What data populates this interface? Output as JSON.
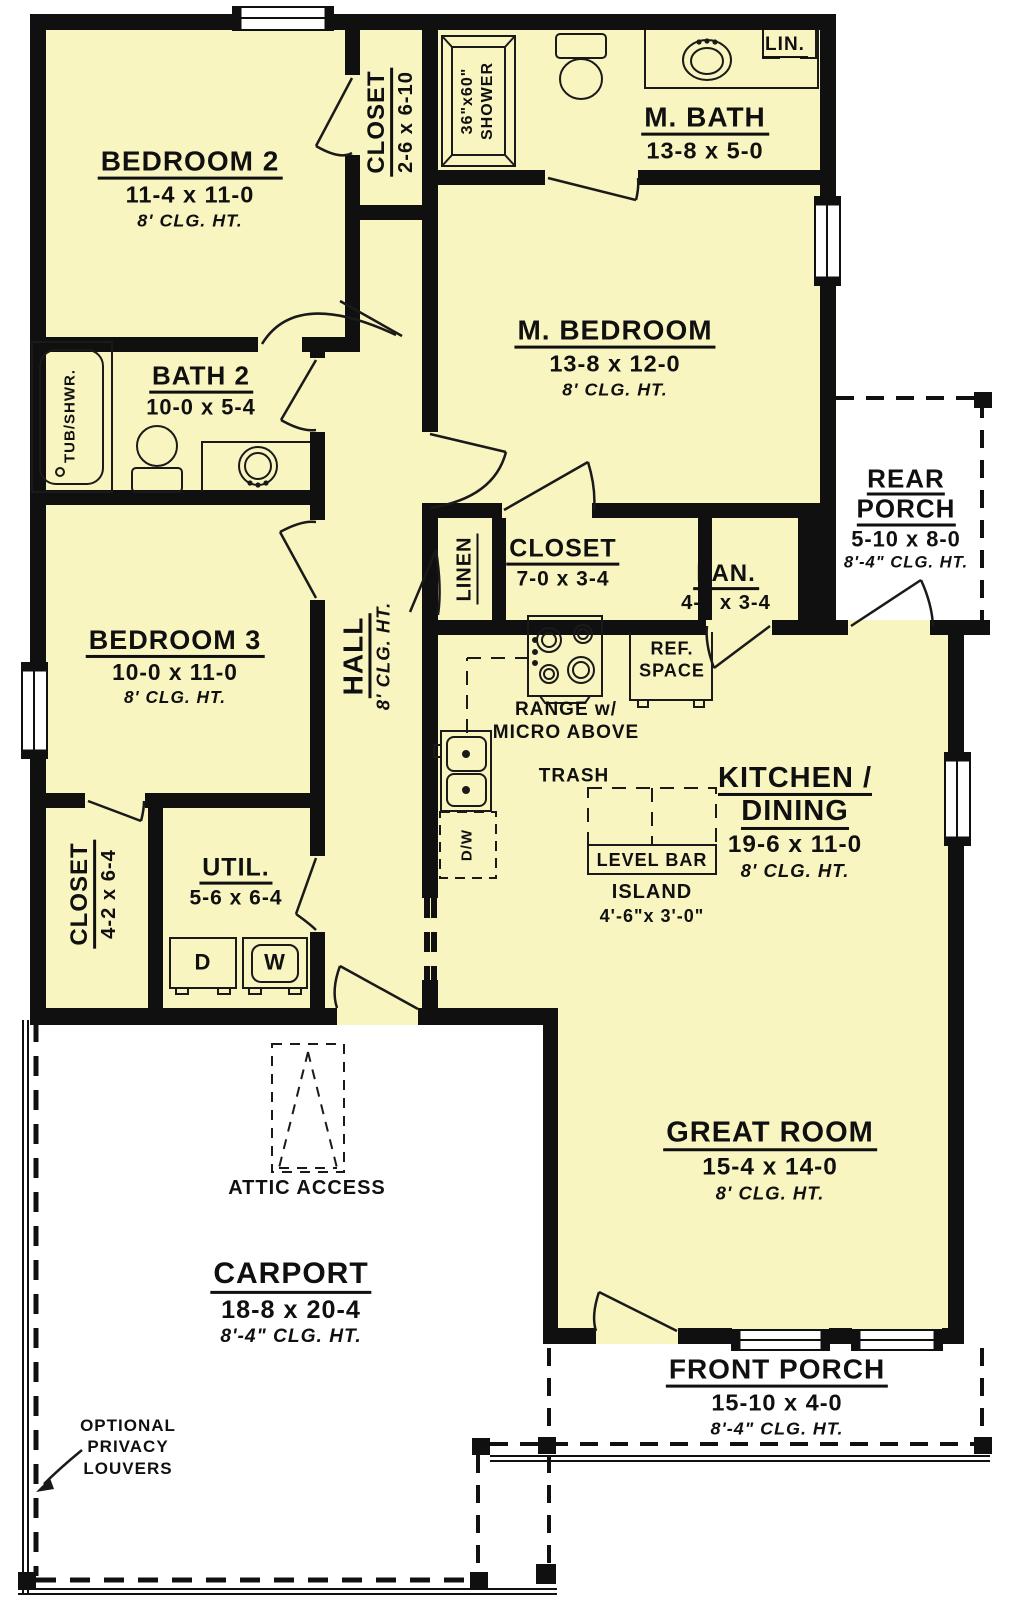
{
  "colors": {
    "room_fill": "#F8F5C1",
    "wall": "#101010",
    "bg": "#FFFFFF",
    "line": "#1A1A1A"
  },
  "rooms": {
    "bedroom2": {
      "name": "BEDROOM 2",
      "dims": "11-4 x 11-0",
      "clg": "8' CLG. HT."
    },
    "closet_bedroom2m": {
      "name": "CLOSET",
      "dims": "2-6 x 6-10"
    },
    "master_bath": {
      "name": "M. BATH",
      "dims": "13-8 x 5-0"
    },
    "lin": {
      "name": "LIN."
    },
    "shower": {
      "size": "36\"x60\"",
      "label": "SHOWER"
    },
    "master_bedroom": {
      "name": "M. BEDROOM",
      "dims": "13-8 x 12-0",
      "clg": "8' CLG. HT."
    },
    "bath2": {
      "name": "BATH 2",
      "dims": "10-0 x 5-4"
    },
    "tub": {
      "label": "TUB/SHWR."
    },
    "bedroom3": {
      "name": "BEDROOM 3",
      "dims": "10-0 x 11-0",
      "clg": "8' CLG. HT."
    },
    "hall": {
      "name": "HALL",
      "clg": "8' CLG. HT."
    },
    "linen": {
      "name": "LINEN"
    },
    "closet_hall": {
      "name": "CLOSET",
      "dims": "7-0 x 3-4"
    },
    "pantry": {
      "name": "PAN.",
      "dims": "4-6 x 3-4"
    },
    "rear_porch": {
      "line1": "REAR",
      "line2": "PORCH",
      "dims": "5-10 x 8-0",
      "clg": "8'-4\" CLG. HT."
    },
    "kitchen": {
      "line1": "KITCHEN /",
      "line2": "DINING",
      "dims": "19-6 x 11-0",
      "clg": "8' CLG. HT."
    },
    "closet_util": {
      "name": "CLOSET",
      "dims": "4-2 x 6-4"
    },
    "util": {
      "name": "UTIL.",
      "dims": "5-6 x 6-4"
    },
    "great_room": {
      "name": "GREAT ROOM",
      "dims": "15-4 x 14-0",
      "clg": "8' CLG. HT."
    },
    "carport": {
      "name": "CARPORT",
      "dims": "18-8 x 20-4",
      "clg": "8'-4\" CLG. HT."
    },
    "front_porch": {
      "name": "FRONT PORCH",
      "dims": "15-10 x 4-0",
      "clg": "8'-4\" CLG. HT."
    }
  },
  "kitchen_items": {
    "range_line1": "RANGE w/",
    "range_line2": "MICRO ABOVE",
    "ref_line1": "REF.",
    "ref_line2": "SPACE",
    "trash": "TRASH",
    "level_bar": "LEVEL BAR",
    "island": "ISLAND",
    "island_dims": "4'-6\"x 3'-0\"",
    "dw": "D/W"
  },
  "util_items": {
    "dryer": "D",
    "washer": "W"
  },
  "notes": {
    "attic": "ATTIC ACCESS",
    "louvers_line1": "OPTIONAL",
    "louvers_line2": "PRIVACY",
    "louvers_line3": "LOUVERS"
  }
}
